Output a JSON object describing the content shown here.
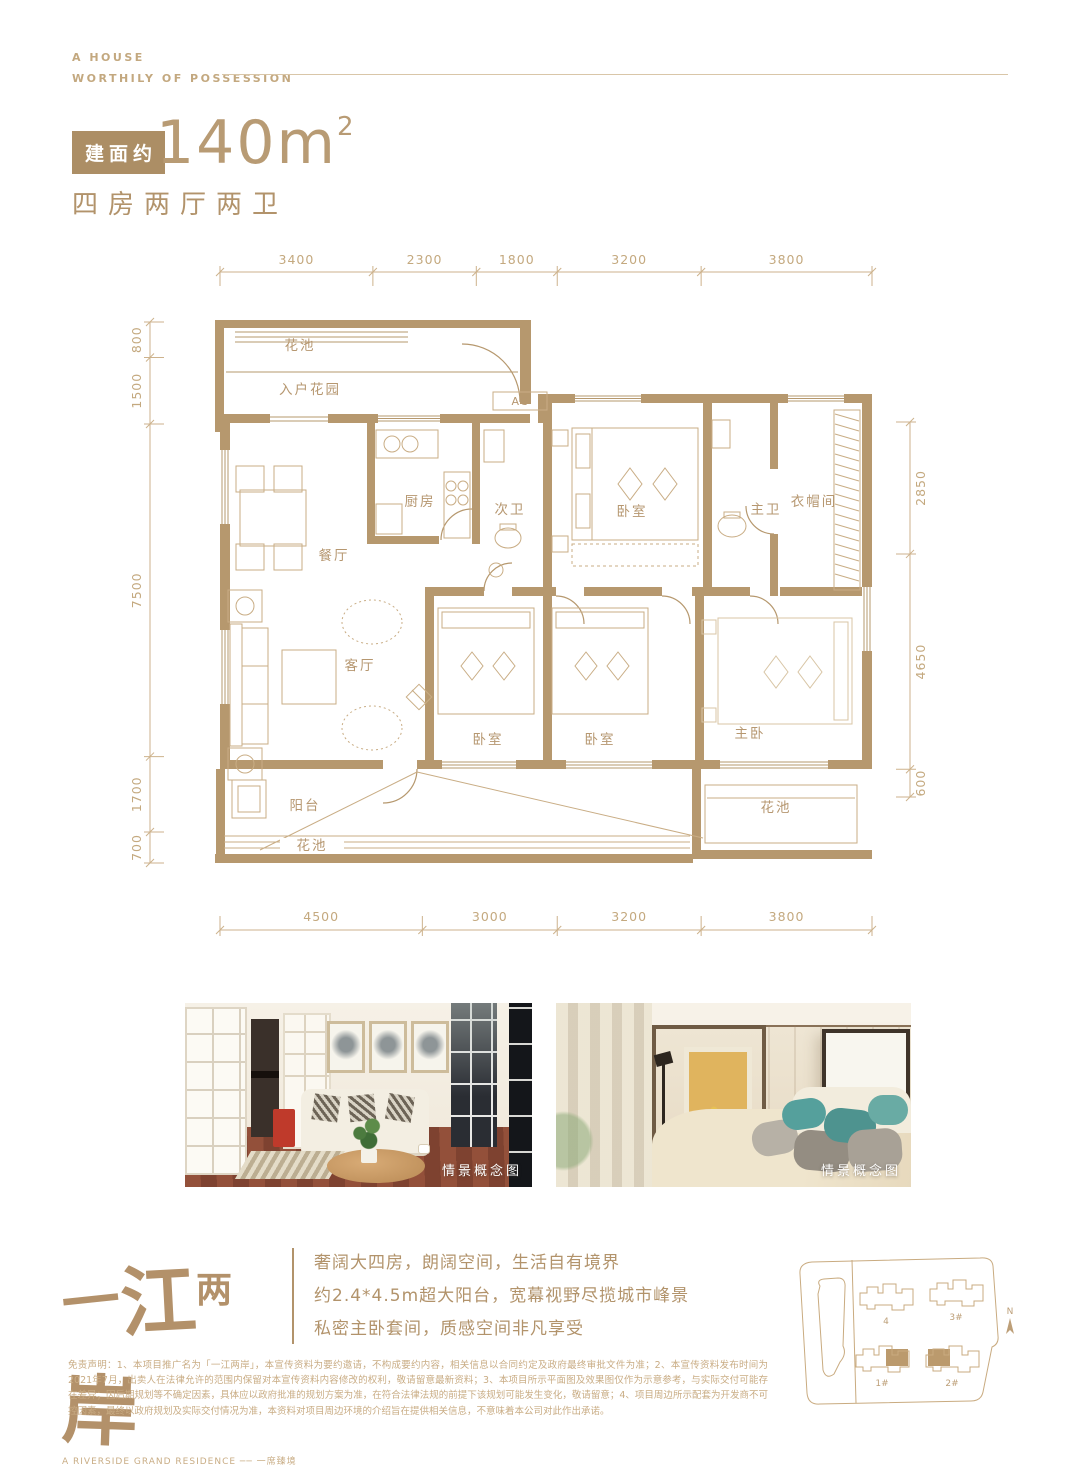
{
  "header": {
    "line1": "A HOUSE",
    "line2": "WORTHILY OF POSSESSION"
  },
  "unit": {
    "badge": "建面约",
    "area": "140m",
    "area_exp": "2",
    "layout": "四房两厅两卫"
  },
  "plan": {
    "dims": {
      "top": [
        3400,
        2300,
        1800,
        3200,
        3800
      ],
      "bottom": [
        4500,
        3000,
        3200,
        3800
      ],
      "left": [
        800,
        1500,
        7500,
        1700,
        700
      ],
      "right": [
        2850,
        4650,
        600
      ]
    },
    "rooms": {
      "flower_top": "花池",
      "entry_garden": "入户花园",
      "dining": "餐厅",
      "kitchen": "厨房",
      "bath2": "次卫",
      "bedroom_a": "卧室",
      "master_bath": "主卫",
      "cloak": "衣帽间",
      "ac": "AC",
      "living": "客厅",
      "bedroom_b": "卧室",
      "bedroom_c": "卧室",
      "master_bedroom": "主卧",
      "balcony": "阳台",
      "flower_bottom": "花池",
      "flower_right": "花池"
    }
  },
  "photos": {
    "caption_left": "情景概念图",
    "caption_right": "情景概念图"
  },
  "brand": {
    "logo_chars": [
      "一",
      "江",
      "两",
      "岸"
    ],
    "logo_sub": "A RIVERSIDE GRAND RESIDENCE ── 一席臻境",
    "points": [
      "奢阔大四房，朗阔空间，生活自有境界",
      "约2.4*4.5m超大阳台，宽幕视野尽揽城市峰景",
      "私密主卧套间，质感空间非凡享受"
    ]
  },
  "siteplan": {
    "labels": [
      "4",
      "3#",
      "1#",
      "2#"
    ],
    "north": "N"
  },
  "disclaimer": "免责声明：1、本项目推广名为「一江两岸」，本宣传资料为要约邀请，不构成要约内容，相关信息以合同约定及政府最终审批文件为准；2、本宣传资料发布时间为2021年7月，出卖人在法律允许的范围内保留对本宣传资料内容修改的权利，敬请留意最新资料；3、本项目所示平面图及效果图仅作为示意参考，与实际交付可能存在差异；因后期规划等不确定因素，具体应以政府批准的规划方案为准，在符合法律法规的前提下该规划可能发生变化，敬请留意；4、项目周边所示配套为开发商不可控因素，最终以政府规划及实际交付情况为准，本资料对项目周边环境的介绍旨在提供相关信息，不意味着本公司对此作出承诺。"
}
